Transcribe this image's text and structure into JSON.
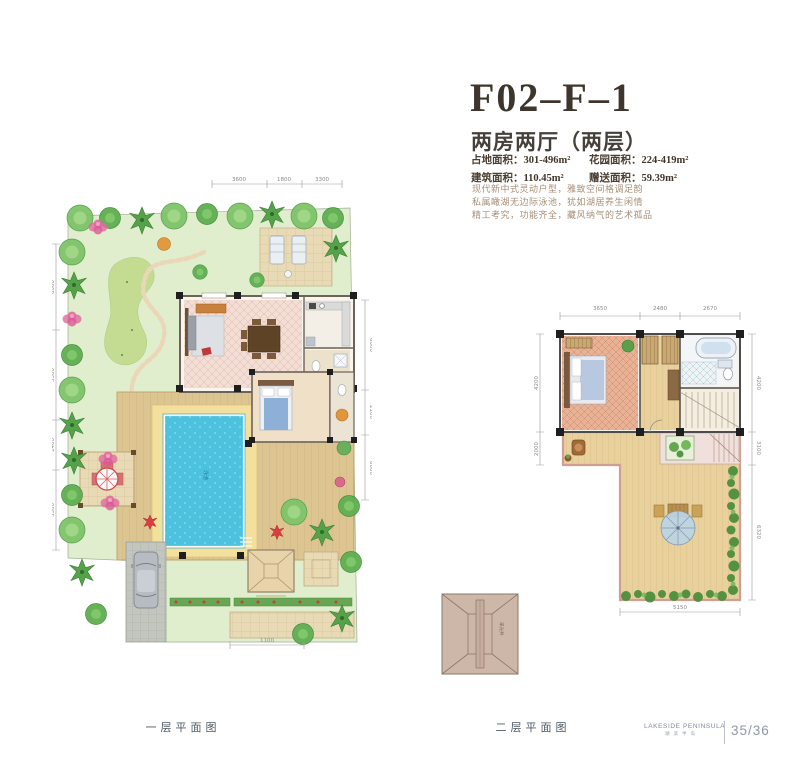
{
  "header": {
    "title": "F02–F–1",
    "subtitle": "两房两厅（两层）",
    "stats": [
      {
        "label": "占地面积：",
        "value": "301-496m²"
      },
      {
        "label": "花园面积：",
        "value": "224-419m²"
      },
      {
        "label": "建筑面积：",
        "value": "110.45m²"
      },
      {
        "label": "赠送面积：",
        "value": "59.39m²"
      }
    ],
    "description": [
      "现代新中式灵动户型，雅致空间格调足韵",
      "私属瞰湖无边际泳池，犹如湖居养生闲情",
      "精工考究，功能齐全，藏风纳气的艺术孤品"
    ]
  },
  "plans": {
    "first_floor": {
      "caption": "一层平面图",
      "pool_label": "泳池",
      "dims_top": [
        "3600",
        "1800",
        "3300"
      ],
      "dims_left": [
        "6000",
        "3500",
        "1400",
        "5500"
      ],
      "dims_right": [
        "6000",
        "2100",
        "6000"
      ],
      "dim_bottom": "1100"
    },
    "second_floor": {
      "caption": "二层平面图",
      "dims_top": [
        "3650",
        "2480",
        "2670"
      ],
      "dims_left": [
        "4200",
        "2000"
      ],
      "dims_right": [
        "4200",
        "3100",
        "6320"
      ],
      "dim_bottom": "5150"
    },
    "roof_detail": {
      "label": "采光井"
    }
  },
  "footer": {
    "brand": "LAKESIDE PENINSULA",
    "brand_cn": "湖滨半岛",
    "page": "35/36"
  },
  "colors": {
    "title_brown": "#3e362c",
    "garden_green": "#e0eecd",
    "lawn_green": "#c3dc92",
    "pool_blue": "#4cc2df",
    "deck_wood": "#ddc592",
    "terrace_wood": "#e9d19e",
    "floor_pink": "#f3ded6"
  }
}
